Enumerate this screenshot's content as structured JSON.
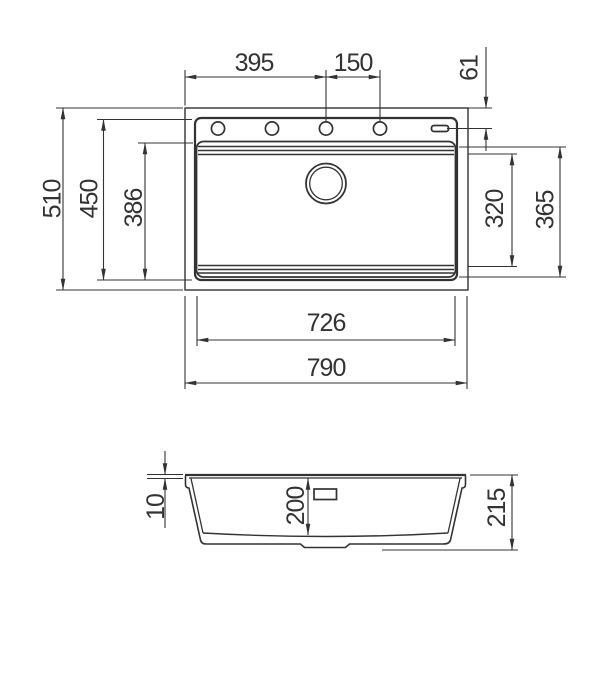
{
  "drawing": {
    "type": "sink-installation-dimension-diagram",
    "units": "mm",
    "colors": {
      "line": "#333333",
      "background": "#ffffff"
    },
    "top_view": {
      "features": [
        "outer-edge",
        "rim",
        "bowl",
        "tap-holes",
        "overflow-slot",
        "drain-hole"
      ],
      "tap_hole_count": 4,
      "dims": {
        "holes_span": "395",
        "hole_spacing": "150",
        "hole_inset": "61",
        "overall_depth": "510",
        "rim_depth": "450",
        "bowl_depth": "386",
        "bowl_width_inner": "320",
        "bowl_width_outer": "365",
        "cutout_width": "726",
        "overall_width": "790"
      }
    },
    "side_view": {
      "features": [
        "rim-profile",
        "bowl-section",
        "overflow-slot",
        "drain-boss"
      ],
      "dims": {
        "rim_height": "10",
        "bowl_inner_depth": "200",
        "overall_height": "215"
      }
    }
  }
}
